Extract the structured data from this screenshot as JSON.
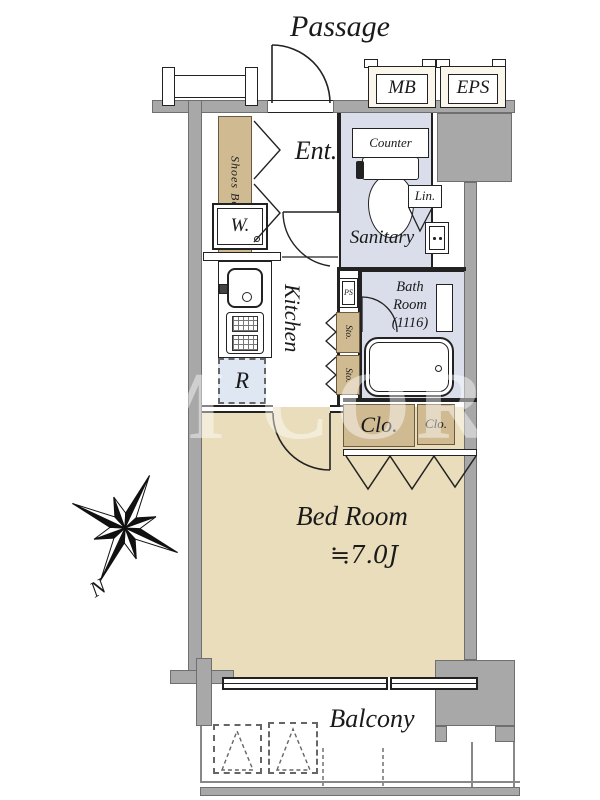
{
  "labels": {
    "passage": "Passage",
    "mb": "MB",
    "eps": "EPS",
    "ent": "Ent.",
    "shoes_box": "Shoes Box",
    "washer": "W.",
    "counter": "Counter",
    "sanitary": "Sanitary",
    "linen": "Lin.",
    "ps": "PS",
    "kitchen": "Kitchen",
    "refrigerator": "R",
    "bath_line1": "Bath",
    "bath_line2": "Room",
    "bath_line3": "(1116)",
    "sto_upper": "Sto.",
    "sto_lower": "Sto.",
    "closet_large": "Clo.",
    "closet_small": "Clo.",
    "bedroom_name": "Bed Room",
    "bedroom_size": "≒7.0J",
    "balcony": "Balcony",
    "north": "N",
    "watermark": "OM CORD"
  },
  "colors": {
    "wall": "#a8a8a8",
    "line": "#222222",
    "bedroom_floor": "#e9ddbb",
    "wet_floor": "#d9deea",
    "storage": "#d0ba92",
    "storage_border": "#6b5a3e",
    "refrigerator_spot": "#dfe7f3",
    "service_box": "#faf6ec"
  }
}
